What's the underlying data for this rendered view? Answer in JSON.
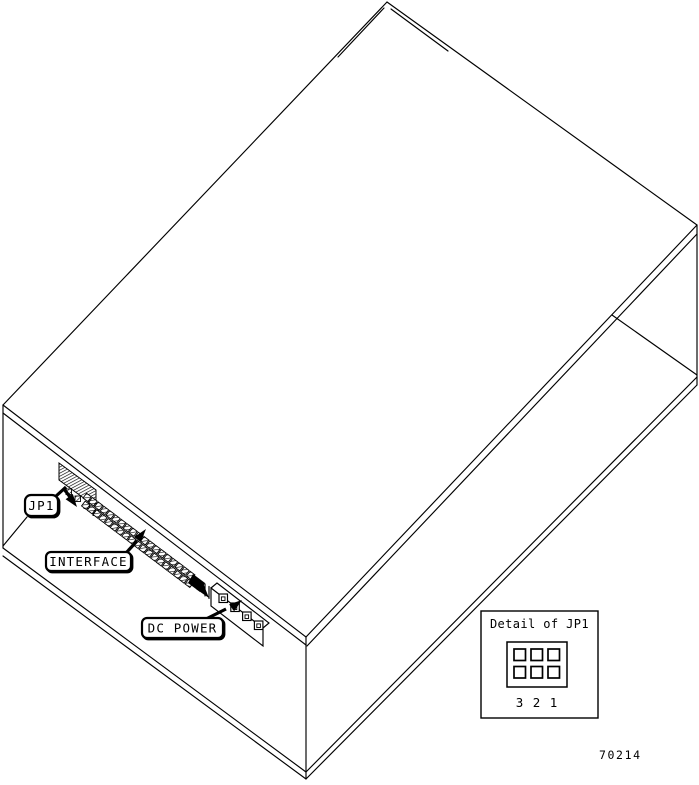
{
  "figure": {
    "number": "70214"
  },
  "colors": {
    "line": "#000000",
    "background": "#ffffff"
  },
  "callouts": {
    "jp1": {
      "label": "JP1"
    },
    "interface": {
      "label": "INTERFACE"
    },
    "dc_power": {
      "label": "DC POWER"
    }
  },
  "detail_inset": {
    "title": "Detail of JP1",
    "pin_labels": [
      "3",
      "2",
      "1"
    ],
    "jumper_grid": {
      "rows": 2,
      "cols": 3
    }
  },
  "connectors": {
    "interface_pin_pairs": 19,
    "dc_power_pins": 4,
    "jp1_under_pins": 4
  }
}
